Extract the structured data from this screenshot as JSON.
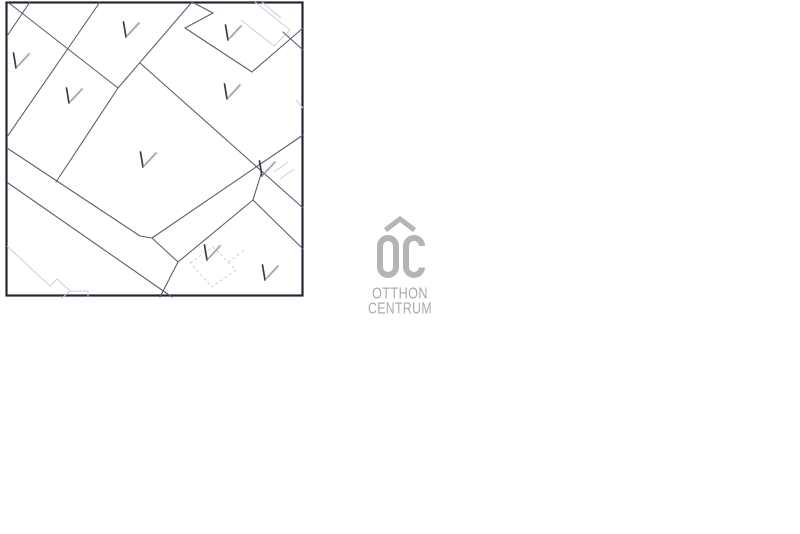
{
  "page": {
    "background": "#ffffff"
  },
  "map": {
    "background": "#ffffff",
    "border": {
      "x": 6.5,
      "y": 2.5,
      "width": 296,
      "height": 293,
      "color": "#232834",
      "stroke_width": 2.2
    },
    "line_color": "#5a5f6a",
    "line_width": 1.1,
    "segments": [
      [
        30,
        2,
        7,
        36
      ],
      [
        9,
        3,
        118,
        88
      ],
      [
        100,
        2,
        7,
        137
      ],
      [
        192,
        2,
        118,
        88
      ],
      [
        118,
        88,
        56,
        182
      ],
      [
        7,
        148,
        140,
        236
      ],
      [
        140,
        236,
        152,
        238
      ],
      [
        152,
        238,
        178,
        262
      ],
      [
        178,
        262,
        160,
        297
      ],
      [
        8,
        183,
        172,
        297
      ],
      [
        192,
        2,
        213,
        13
      ],
      [
        213,
        13,
        185,
        28
      ],
      [
        185,
        28,
        252,
        72
      ],
      [
        252,
        72,
        303,
        28
      ],
      [
        140,
        63,
        303,
        208
      ],
      [
        303,
        135,
        152,
        238
      ],
      [
        178,
        262,
        253,
        200
      ],
      [
        253,
        200,
        303,
        249
      ],
      [
        253,
        200,
        261,
        174
      ],
      [
        283,
        32,
        303,
        50
      ]
    ],
    "building_color": "#cbd0d6",
    "building_width": 1,
    "buildings": [
      {
        "points": [
          [
            255,
            2
          ],
          [
            290,
            30
          ],
          [
            274,
            46
          ],
          [
            241,
            20
          ]
        ],
        "dashed": false
      },
      {
        "points": [
          [
            262,
            2
          ],
          [
            281,
            18
          ]
        ],
        "dashed": false
      },
      {
        "points": [
          [
            7,
            246
          ],
          [
            50,
            286
          ],
          [
            57,
            279
          ],
          [
            70,
            291
          ],
          [
            62,
            298
          ]
        ],
        "dashed": false
      },
      {
        "points": [
          [
            70,
            291
          ],
          [
            88,
            291
          ],
          [
            88,
            298
          ]
        ],
        "dashed": false
      },
      {
        "points": [
          [
            190,
            263
          ],
          [
            213,
            247
          ],
          [
            236,
            270
          ],
          [
            212,
            287
          ],
          [
            190,
            263
          ]
        ],
        "dashed": true
      },
      {
        "points": [
          [
            228,
            262
          ],
          [
            246,
            249
          ]
        ],
        "dashed": true
      },
      {
        "points": [
          [
            274,
            172
          ],
          [
            288,
            162
          ]
        ],
        "dashed": false
      },
      {
        "points": [
          [
            280,
            179
          ],
          [
            294,
            169
          ]
        ],
        "dashed": false
      },
      {
        "points": [
          [
            296,
            100
          ],
          [
            303,
            108
          ]
        ],
        "dashed": false
      }
    ],
    "v_marks": [
      [
        16,
        68
      ],
      [
        69,
        103
      ],
      [
        126,
        37
      ],
      [
        228,
        40
      ],
      [
        227,
        99
      ],
      [
        143,
        167
      ],
      [
        262,
        176
      ],
      [
        207,
        260
      ],
      [
        265,
        280
      ]
    ],
    "v_mark_dark": "#3a3d44",
    "v_mark_light": "#8d939c",
    "v_mark_smear": "#c2c6cc"
  },
  "logo": {
    "monogram": "OC",
    "line1": "OTTHON",
    "line2": "CENTRUM",
    "mark_color": "#b3b4b6",
    "text_color": "#a9aaac"
  }
}
